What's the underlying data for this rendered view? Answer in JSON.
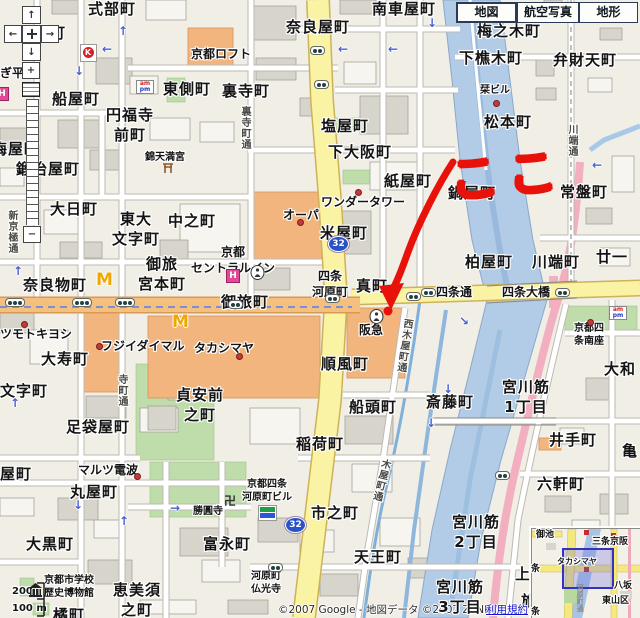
{
  "tabs": {
    "map": "地図",
    "aerial": "航空写真",
    "terrain": "地形"
  },
  "zoom_controls": {
    "in": "+",
    "out": "−"
  },
  "annotation": {
    "koko": "ここ"
  },
  "attribution": {
    "copyright": "©2007 Google - 地図データ ©2007 ZENRIN",
    "terms": "利用規約"
  },
  "scale": {
    "upper": "200",
    "lower": "100 m"
  },
  "route_shield": "32",
  "icon_text": {
    "mcdonalds": "M",
    "hotel": "H",
    "circle_k": "K",
    "am": "am",
    "pm": "pm",
    "manji": "卍"
  },
  "map_labels": [
    {
      "n": "shikibucho",
      "t": "式部町",
      "x": 88,
      "y": 0,
      "c": "town"
    },
    {
      "n": "kagiyacho-partial",
      "t": "屋町",
      "x": 34,
      "y": 24,
      "c": "town"
    },
    {
      "n": "minamikurumayacho",
      "t": "南車屋町",
      "x": 372,
      "y": 0,
      "c": "town"
    },
    {
      "n": "narayacho",
      "t": "奈良屋町",
      "x": 286,
      "y": 18,
      "c": "town"
    },
    {
      "n": "umenokicho",
      "t": "梅之木町",
      "x": 477,
      "y": 22,
      "c": "town"
    },
    {
      "n": "shimokorikicho",
      "t": "下樵木町",
      "x": 459,
      "y": 49,
      "c": "town"
    },
    {
      "n": "benzaitencho",
      "t": "弁財天町",
      "x": 553,
      "y": 51,
      "c": "town"
    },
    {
      "n": "higashigawacho",
      "t": "東側町",
      "x": 163,
      "y": 80,
      "c": "town"
    },
    {
      "n": "uraderacho",
      "t": "裏寺町",
      "x": 222,
      "y": 82,
      "c": "town"
    },
    {
      "n": "funayacho",
      "t": "船屋町",
      "x": 52,
      "y": 90,
      "c": "town"
    },
    {
      "n": "enpukujimaecho",
      "t": "円福寺\n前町",
      "x": 106,
      "y": 106,
      "c": "town town-c"
    },
    {
      "n": "umeyacho",
      "t": "梅屋町",
      "x": -8,
      "y": 140,
      "c": "town"
    },
    {
      "n": "shioyacho",
      "t": "塩屋町",
      "x": 321,
      "y": 117,
      "c": "town"
    },
    {
      "n": "shimoosakacho",
      "t": "下大阪町",
      "x": 328,
      "y": 143,
      "c": "town"
    },
    {
      "n": "matsumotocho",
      "t": "松本町",
      "x": 484,
      "y": 113,
      "c": "town"
    },
    {
      "n": "kamiyacho",
      "t": "紙屋町",
      "x": 384,
      "y": 172,
      "c": "town"
    },
    {
      "n": "nabeyacho",
      "t": "鍋屋町",
      "x": 448,
      "y": 184,
      "c": "town"
    },
    {
      "n": "tokiwacho",
      "t": "常盤町",
      "x": 560,
      "y": 183,
      "c": "town"
    },
    {
      "n": "kajiyacho",
      "t": "鍛冶屋町",
      "x": 16,
      "y": 160,
      "c": "town"
    },
    {
      "n": "dainichicho",
      "t": "大日町",
      "x": 50,
      "y": 200,
      "c": "town"
    },
    {
      "n": "nakanocho",
      "t": "中之町",
      "x": 168,
      "y": 212,
      "c": "town"
    },
    {
      "n": "higashidaimonjicho",
      "t": "東大\n文字町",
      "x": 112,
      "y": 210,
      "c": "town town-c"
    },
    {
      "n": "komeyacho",
      "t": "米屋町",
      "x": 320,
      "y": 224,
      "c": "town"
    },
    {
      "n": "kashiwayacho",
      "t": "柏屋町",
      "x": 465,
      "y": 253,
      "c": "town"
    },
    {
      "n": "kawabatacho",
      "t": "川端町",
      "x": 532,
      "y": 253,
      "c": "town"
    },
    {
      "n": "nijuichi-partial",
      "t": "廿一",
      "x": 596,
      "y": 248,
      "c": "town"
    },
    {
      "n": "otabimiyamotocho",
      "t": "御旅\n宮本町",
      "x": 138,
      "y": 255,
      "c": "town town-c"
    },
    {
      "n": "naramonocho",
      "t": "奈良物町",
      "x": 23,
      "y": 276,
      "c": "town"
    },
    {
      "n": "otabicho",
      "t": "御旅町",
      "x": 221,
      "y": 293,
      "c": "town"
    },
    {
      "n": "shinmachi",
      "t": "真町",
      "x": 356,
      "y": 277,
      "c": "town"
    },
    {
      "n": "junpucho",
      "t": "順風町",
      "x": 321,
      "y": 355,
      "c": "town"
    },
    {
      "n": "sendocho",
      "t": "船頭町",
      "x": 349,
      "y": 398,
      "c": "town"
    },
    {
      "n": "inaricho",
      "t": "稲荷町",
      "x": 296,
      "y": 435,
      "c": "town"
    },
    {
      "n": "saitocho",
      "t": "斎藤町",
      "x": 426,
      "y": 393,
      "c": "town"
    },
    {
      "n": "daijucho",
      "t": "大寿町",
      "x": 41,
      "y": 350,
      "c": "town"
    },
    {
      "n": "monjicho",
      "t": "文字町",
      "x": 0,
      "y": 382,
      "c": "town"
    },
    {
      "n": "teianmaenocho",
      "t": "貞安前\n之町",
      "x": 176,
      "y": 386,
      "c": "town town-c"
    },
    {
      "n": "tabiyacho",
      "t": "足袋屋町",
      "x": 66,
      "y": 418,
      "c": "town"
    },
    {
      "n": "maruyacho",
      "t": "丸屋町",
      "x": 70,
      "y": 483,
      "c": "town"
    },
    {
      "n": "yacho-partial",
      "t": "屋町",
      "x": 0,
      "y": 465,
      "c": "town"
    },
    {
      "n": "daikokucho",
      "t": "大黒町",
      "x": 26,
      "y": 535,
      "c": "town"
    },
    {
      "n": "tachibanacho",
      "t": "橘町",
      "x": 53,
      "y": 606,
      "c": "town"
    },
    {
      "n": "ebisunocho",
      "t": "恵美須\n之町",
      "x": 113,
      "y": 581,
      "c": "town town-c"
    },
    {
      "n": "tominagacho",
      "t": "富永町",
      "x": 203,
      "y": 535,
      "c": "town"
    },
    {
      "n": "ichinocho",
      "t": "市之町",
      "x": 311,
      "y": 504,
      "c": "town"
    },
    {
      "n": "tennocho",
      "t": "天王町",
      "x": 354,
      "y": 548,
      "c": "town"
    },
    {
      "n": "idecho",
      "t": "井手町",
      "x": 549,
      "y": 431,
      "c": "town"
    },
    {
      "n": "kame-partial",
      "t": "亀",
      "x": 622,
      "y": 442,
      "c": "town"
    },
    {
      "n": "rokkencho",
      "t": "六軒町",
      "x": 537,
      "y": 475,
      "c": "town"
    },
    {
      "n": "miyagawasuji1",
      "t": "宮川筋\n1丁目",
      "x": 502,
      "y": 378,
      "c": "town town-c"
    },
    {
      "n": "miyagawasuji2",
      "t": "宮川筋\n2丁目",
      "x": 452,
      "y": 513,
      "c": "town town-c"
    },
    {
      "n": "miyagawasuji3",
      "t": "宮川筋\n3丁目",
      "x": 436,
      "y": 578,
      "c": "town town-c"
    },
    {
      "n": "yamato-partial",
      "t": "大和",
      "x": 604,
      "y": 360,
      "c": "town"
    },
    {
      "n": "kami-partial",
      "t": "上",
      "x": 515,
      "y": 565,
      "c": "town"
    },
    {
      "n": "ryo-partial",
      "t": "旅",
      "x": 521,
      "y": 592,
      "c": "town"
    },
    {
      "n": "gihei-partial",
      "t": "ぎ平",
      "x": 0,
      "y": 66,
      "c": "poi"
    },
    {
      "n": "kyoto-loft",
      "t": "京都ロフト",
      "x": 191,
      "y": 47,
      "c": "poi"
    },
    {
      "n": "nishiki-tenmangu",
      "t": "錦天満宮",
      "x": 145,
      "y": 151,
      "c": "poi-s"
    },
    {
      "n": "wonder-tower",
      "t": "ワンダータワー",
      "x": 321,
      "y": 195,
      "c": "poi"
    },
    {
      "n": "opa",
      "t": "オーパ",
      "x": 283,
      "y": 208,
      "c": "poi"
    },
    {
      "n": "shiori-bldg",
      "t": "栞ビル",
      "x": 480,
      "y": 84,
      "c": "poi-s"
    },
    {
      "n": "kyoto-central-inn",
      "t": "京都\nセントラルイン",
      "x": 191,
      "y": 245,
      "c": "poi town-c"
    },
    {
      "n": "takashimaya",
      "t": "タカシマヤ",
      "x": 194,
      "y": 341,
      "c": "poi"
    },
    {
      "n": "fujii-daimaru",
      "t": "フジイダイマル",
      "x": 101,
      "y": 339,
      "c": "poi"
    },
    {
      "n": "matsumotokiyoshi-partial",
      "t": "ツモトキヨシ",
      "x": 0,
      "y": 327,
      "c": "poi"
    },
    {
      "n": "hankyu",
      "t": "阪急",
      "x": 359,
      "y": 323,
      "c": "poi"
    },
    {
      "n": "marutsu-denpa",
      "t": "マルツ電波",
      "x": 78,
      "y": 463,
      "c": "poi"
    },
    {
      "n": "shoenji",
      "t": "勝圓寺",
      "x": 193,
      "y": 505,
      "c": "poi-s"
    },
    {
      "n": "kyoto-shijo-minamiza",
      "t": "京都四\n条南座",
      "x": 574,
      "y": 322,
      "c": "poi-s town-c"
    },
    {
      "n": "school-museum",
      "t": "京都市学校\n歴史博物館",
      "x": 44,
      "y": 574,
      "c": "poi-s town-c"
    },
    {
      "n": "kawaramachi-bldg",
      "t": "京都四条\n河原町ビル",
      "x": 242,
      "y": 478,
      "c": "poi-s town-c"
    },
    {
      "n": "kawaramachi-bukkoji",
      "t": "河原町\n仏光寺",
      "x": 251,
      "y": 570,
      "c": "poi-s town-c"
    },
    {
      "n": "shijo-kawaramachi-sta",
      "t": "四条\n河原町",
      "x": 312,
      "y": 269,
      "c": "sta"
    },
    {
      "n": "shijo-dori",
      "t": "四条通",
      "x": 436,
      "y": 285,
      "c": "road"
    },
    {
      "n": "shijo-ohashi",
      "t": "四条大橋",
      "x": 502,
      "y": 285,
      "c": "road"
    },
    {
      "n": "shinkyogoku-dori",
      "t": "新京極通",
      "x": 5,
      "y": 210,
      "c": "vroad"
    },
    {
      "n": "teramachi-dori",
      "t": "寺町通",
      "x": 115,
      "y": 374,
      "c": "vroad"
    },
    {
      "n": "uraderamachi-dori",
      "t": "裏寺町通",
      "x": 238,
      "y": 106,
      "c": "vroad"
    },
    {
      "n": "nishikiyamachi-dori",
      "t": "西木屋町通",
      "x": 397,
      "y": 318,
      "c": "vroad",
      "r": 8
    },
    {
      "n": "kiyamachi-dori",
      "t": "木屋町通",
      "x": 374,
      "y": 458,
      "c": "vroad",
      "r": 14
    },
    {
      "n": "kawabata-dori",
      "t": "川端通",
      "x": 565,
      "y": 124,
      "c": "vroad"
    },
    {
      "n": "mini-oike",
      "t": "御池",
      "x": 536,
      "y": 530,
      "c": "mini"
    },
    {
      "n": "mini-sanjo-keihan",
      "t": "三条京阪",
      "x": 592,
      "y": 537,
      "c": "mini"
    },
    {
      "n": "mini-takashimaya",
      "t": "タカシマヤ",
      "x": 557,
      "y": 557,
      "c": "mini-s"
    },
    {
      "n": "mini-jo1",
      "t": "条",
      "x": 531,
      "y": 564,
      "c": "mini"
    },
    {
      "n": "mini-yasaka",
      "t": "八坂",
      "x": 614,
      "y": 581,
      "c": "mini"
    },
    {
      "n": "mini-higashiyamaku",
      "t": "東山区",
      "x": 602,
      "y": 596,
      "c": "mini"
    },
    {
      "n": "mini-jo2",
      "t": "条",
      "x": 531,
      "y": 607,
      "c": "mini"
    },
    {
      "n": "mini-kawaramachidori",
      "t": "河原町通",
      "x": 575,
      "y": 584,
      "c": "minv"
    }
  ],
  "poi_dots": [
    {
      "x": 297,
      "y": 219
    },
    {
      "x": 355,
      "y": 189
    },
    {
      "x": 493,
      "y": 100
    },
    {
      "x": 236,
      "y": 353
    },
    {
      "x": 96,
      "y": 343
    },
    {
      "x": 21,
      "y": 321
    },
    {
      "x": 134,
      "y": 473
    },
    {
      "x": 587,
      "y": 319
    }
  ],
  "signals": [
    {
      "x": 310,
      "y": 46,
      "d": 2
    },
    {
      "x": 314,
      "y": 80,
      "d": 2
    },
    {
      "x": 5,
      "y": 298,
      "d": 3
    },
    {
      "x": 72,
      "y": 298,
      "d": 3
    },
    {
      "x": 115,
      "y": 298,
      "d": 3
    },
    {
      "x": 228,
      "y": 300,
      "d": 2
    },
    {
      "x": 325,
      "y": 294,
      "d": 2
    },
    {
      "x": 406,
      "y": 292,
      "d": 2
    },
    {
      "x": 555,
      "y": 288,
      "d": 2
    },
    {
      "x": 421,
      "y": 288,
      "d": 2
    },
    {
      "x": 268,
      "y": 563,
      "d": 2
    },
    {
      "x": 495,
      "y": 471,
      "d": 2
    }
  ],
  "arrows": [
    {
      "x": 118,
      "y": 24,
      "g": "↑"
    },
    {
      "x": 102,
      "y": 42,
      "g": "←"
    },
    {
      "x": 74,
      "y": 64,
      "g": "↓"
    },
    {
      "x": 338,
      "y": 42,
      "g": "←"
    },
    {
      "x": 388,
      "y": 42,
      "g": "←"
    },
    {
      "x": 427,
      "y": 16,
      "g": "↓"
    },
    {
      "x": 592,
      "y": 158,
      "g": "←"
    },
    {
      "x": 13,
      "y": 264,
      "g": "↑"
    },
    {
      "x": 10,
      "y": 396,
      "g": "↑"
    },
    {
      "x": 73,
      "y": 498,
      "g": "↓"
    },
    {
      "x": 119,
      "y": 514,
      "g": "↑"
    },
    {
      "x": 170,
      "y": 501,
      "g": "→"
    },
    {
      "x": 459,
      "y": 314,
      "g": "↘"
    },
    {
      "x": 443,
      "y": 382,
      "g": "↓"
    },
    {
      "x": 426,
      "y": 416,
      "g": "↓"
    }
  ]
}
